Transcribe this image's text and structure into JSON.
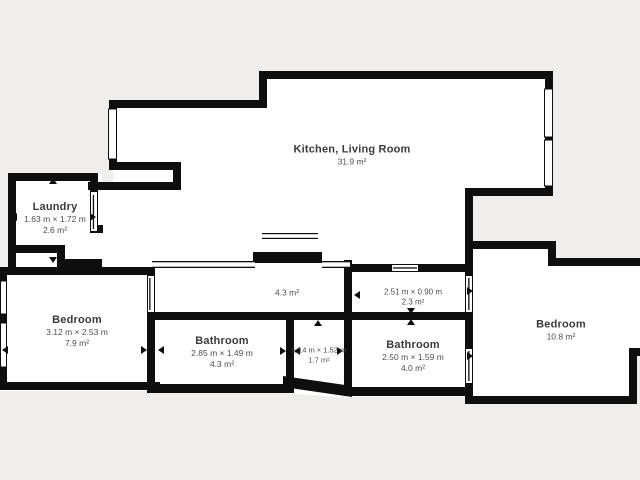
{
  "title": "Apartment floor plan",
  "colors": {
    "background": "#efeeec",
    "floor": "#ffffff",
    "wall": "#0e0e0e",
    "room_name_text": "#3b3b3b",
    "room_meta_text": "#4e4e4e"
  },
  "rooms": {
    "kitchen_living": {
      "name": "Kitchen, Living Room",
      "area": "31.9 m²"
    },
    "laundry": {
      "name": "Laundry",
      "dimensions": "1.63 m × 1.72 m",
      "area": "2.6 m²"
    },
    "hall": {
      "area": "4.3 m²"
    },
    "corridor": {
      "dimensions": "2.51 m × 0.90 m",
      "area": "2.3 m²"
    },
    "bedroom_left": {
      "name": "Bedroom",
      "dimensions": "3.12 m × 2.53 m",
      "area": "7.9 m²"
    },
    "bathroom_left": {
      "name": "Bathroom",
      "dimensions": "2.85 m × 1.49 m",
      "area": "4.3 m²"
    },
    "storage": {
      "dimensions": "1.14 m × 1.52 m",
      "area": "1.7 m²"
    },
    "bathroom_right": {
      "name": "Bathroom",
      "dimensions": "2.50 m × 1.59 m",
      "area": "4.0 m²"
    },
    "bedroom_right": {
      "name": "Bedroom",
      "area": "10.8 m²"
    }
  }
}
